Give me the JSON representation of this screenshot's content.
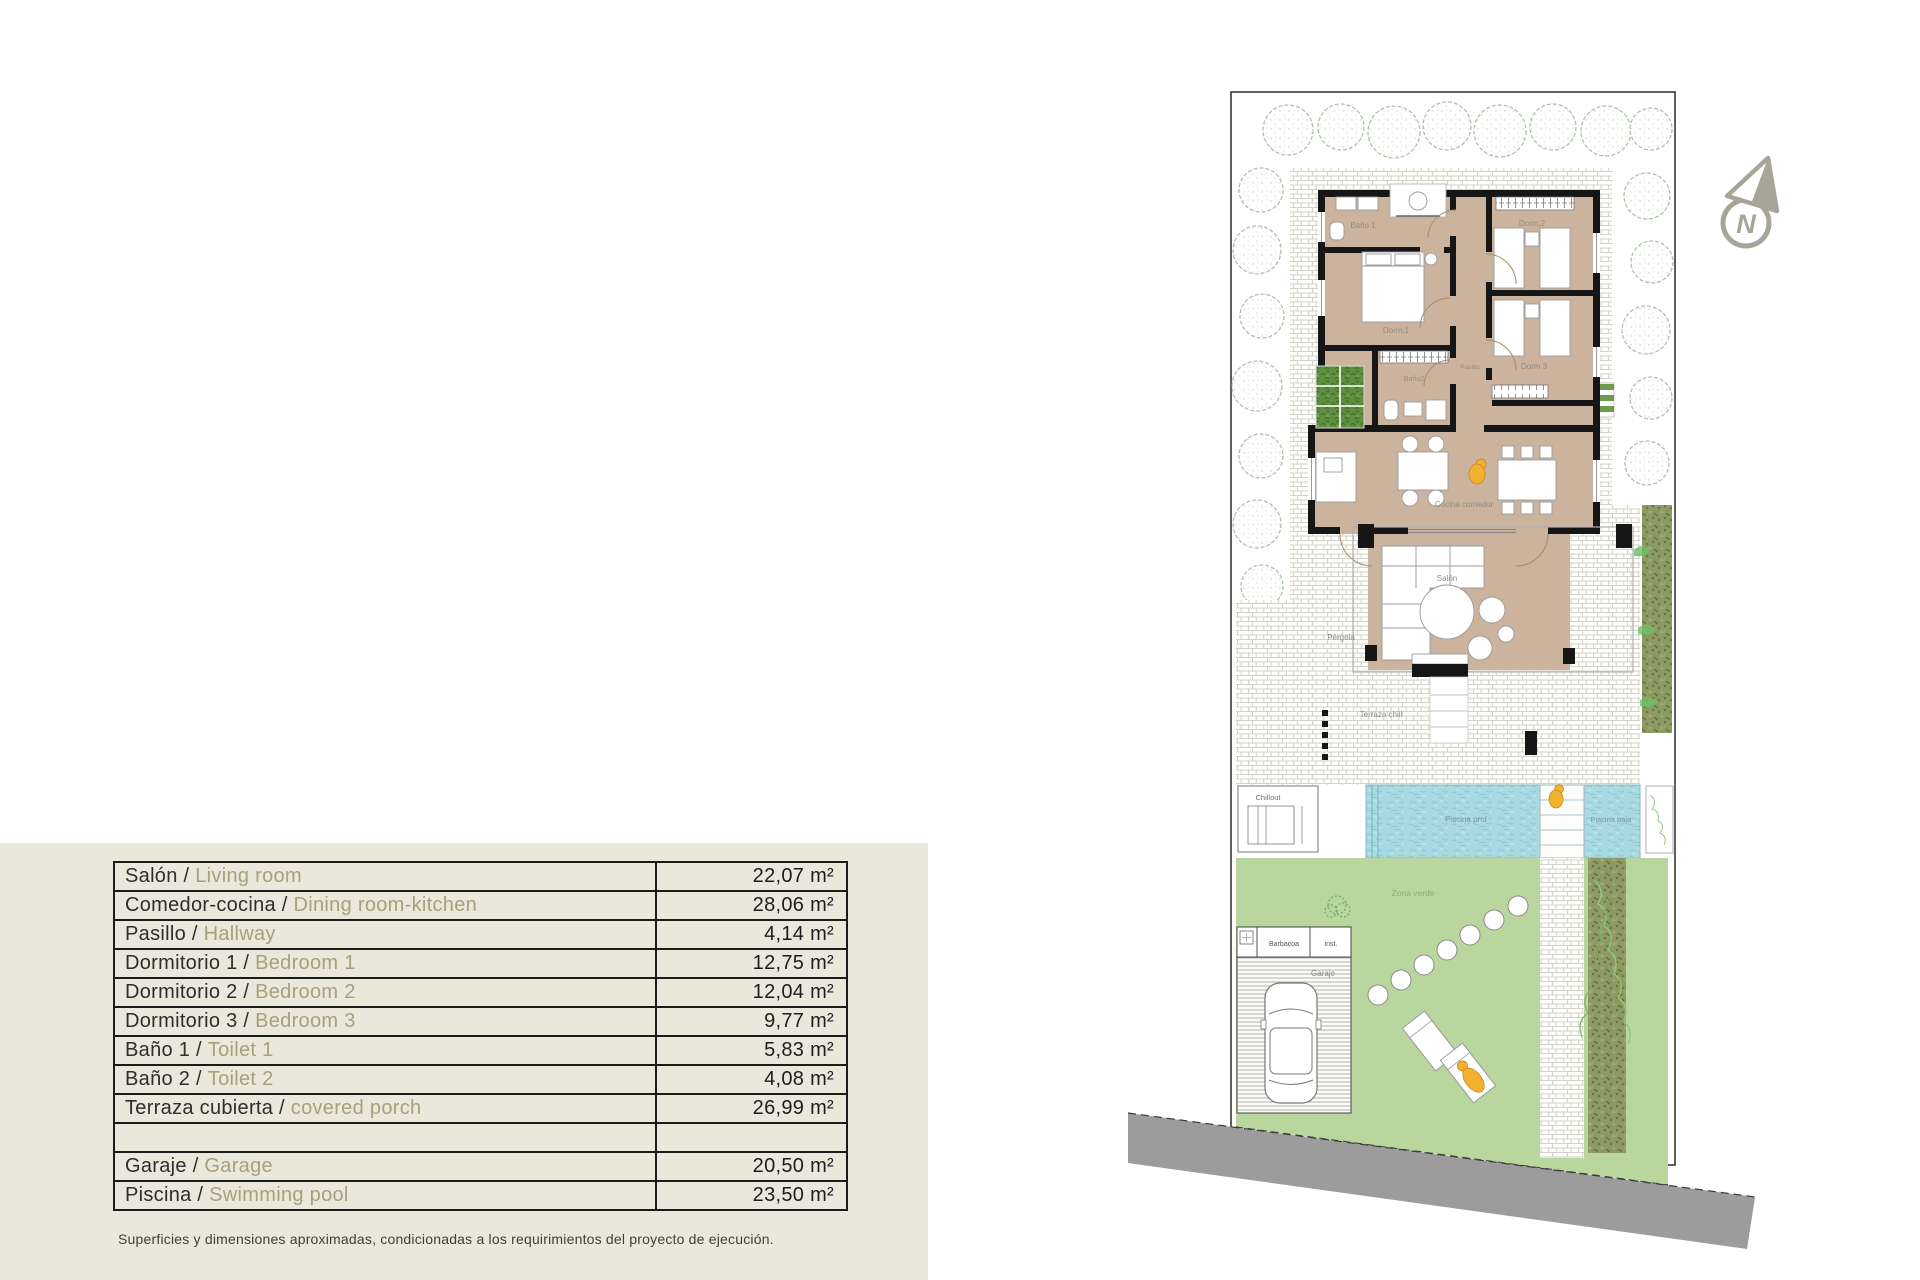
{
  "area_table": {
    "separator": " / ",
    "rows": [
      {
        "es": "Salón",
        "en": "Living room",
        "area": "22,07 m²"
      },
      {
        "es": "Comedor-cocina",
        "en": "Dining room-kitchen",
        "area": "28,06 m²"
      },
      {
        "es": "Pasillo",
        "en": "Hallway",
        "area": "4,14 m²"
      },
      {
        "es": "Dormitorio 1",
        "en": "Bedroom 1",
        "area": "12,75 m²"
      },
      {
        "es": "Dormitorio 2",
        "en": "Bedroom 2",
        "area": "12,04 m²"
      },
      {
        "es": "Dormitorio 3",
        "en": "Bedroom 3",
        "area": "9,77 m²"
      },
      {
        "es": "Baño 1",
        "en": "Toilet 1",
        "area": "5,83 m²"
      },
      {
        "es": "Baño 2",
        "en": "Toilet 2",
        "area": "4,08 m²"
      },
      {
        "es": "Terraza cubierta",
        "en": "covered porch",
        "area": "26,99 m²"
      },
      {
        "es": "",
        "en": "",
        "area": ""
      },
      {
        "es": "Garaje",
        "en": "Garage",
        "area": "20,50 m²"
      },
      {
        "es": "Piscina",
        "en": "Swimming pool",
        "area": "23,50 m²"
      }
    ],
    "footnote": "Superficies y dimensiones aproximadas, condicionadas a los requirimientos del proyecto de ejecución."
  },
  "floor_plan": {
    "labels": {
      "bano1": "Baño 1",
      "dorm2": "Dorm.2",
      "dorm1": "Dorm.1",
      "pasillo": "Pasillo",
      "bano2": "Baño2",
      "dorm3": "Dorm 3",
      "cocina": "Cocina comedor",
      "salon": "Salón",
      "pergola": "Pérgola",
      "terraza": "Terraza chill",
      "chillout": "Chillout",
      "piscina_prof": "Piscina prof",
      "piscina_baja": "Piscina baja",
      "zona_verde": "Zona verde",
      "barbacoa": "Barbacoa",
      "inst": "inst.",
      "garaje": "Garaje"
    },
    "north_letter": "N",
    "colors": {
      "panel_beige": "#eae7db",
      "floor_tan": "#ccb39e",
      "wall_black": "#161616",
      "pool_blue": "#a9dae2",
      "lawn_green": "#b8d69d",
      "hedge_green": "#8e9a63",
      "planter_green": "#5d8f3f",
      "road_gray": "#9c9c9c",
      "tree_outline": "#adc3a8",
      "accent_orange": "#f3b130",
      "label_gray": "#8f8d82",
      "english_olive": "#a7a07d"
    }
  }
}
